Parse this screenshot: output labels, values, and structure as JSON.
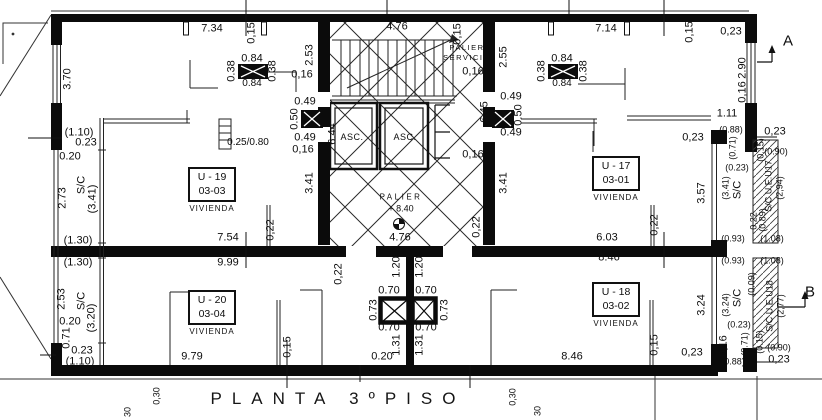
{
  "plan": {
    "title": "PLANTA 3ºPISO",
    "core": {
      "palier_servicio_1": "PALIER",
      "palier_servicio_2": "SERVICIO",
      "elevator_1": "ASC.",
      "elevator_2": "ASC.",
      "palier": "PALIER",
      "palier_level": "+ 8.40"
    },
    "section_markers": {
      "a": "A",
      "b": "B"
    },
    "units": [
      {
        "id": "U - 19",
        "number": "03-03",
        "use": "VIVIENDA"
      },
      {
        "id": "U - 17",
        "number": "03-01",
        "use": "VIVIENDA"
      },
      {
        "id": "U - 20",
        "number": "03-04",
        "use": "VIVIENDA"
      },
      {
        "id": "U - 18",
        "number": "03-02",
        "use": "VIVIENDA"
      }
    ],
    "dimensions": [
      {
        "t": "7.34",
        "x": 212,
        "y": 29
      },
      {
        "t": "0,15",
        "x": 252,
        "y": 33,
        "r": 1
      },
      {
        "t": "4.76",
        "x": 397,
        "y": 27
      },
      {
        "t": "0,15",
        "x": 458,
        "y": 34,
        "r": 1
      },
      {
        "t": "7.14",
        "x": 606,
        "y": 29
      },
      {
        "t": "0,15",
        "x": 690,
        "y": 32,
        "r": 1
      },
      {
        "t": "0,23",
        "x": 731,
        "y": 32
      },
      {
        "t": "2.90",
        "x": 743,
        "y": 68,
        "r": 1
      },
      {
        "t": "0,16",
        "x": 743,
        "y": 92,
        "r": 1
      },
      {
        "t": "1.11",
        "x": 727,
        "y": 114
      },
      {
        "t": "3.70",
        "x": 68,
        "y": 79,
        "r": 1
      },
      {
        "t": "(1.10)",
        "x": 79,
        "y": 133
      },
      {
        "t": "0.23",
        "x": 86,
        "y": 143
      },
      {
        "t": "0.20",
        "x": 70,
        "y": 157
      },
      {
        "t": "2.73",
        "x": 63,
        "y": 198,
        "r": 1
      },
      {
        "t": "S/C",
        "x": 82,
        "y": 185,
        "r": 1
      },
      {
        "t": "(3.41)",
        "x": 93,
        "y": 199,
        "r": 1
      },
      {
        "t": "(1.30)",
        "x": 78,
        "y": 241
      },
      {
        "t": "(1.30)",
        "x": 78,
        "y": 263
      },
      {
        "t": "2.53",
        "x": 62,
        "y": 299,
        "r": 1
      },
      {
        "t": "S/C",
        "x": 82,
        "y": 301,
        "r": 1
      },
      {
        "t": "(3.20)",
        "x": 92,
        "y": 318,
        "r": 1
      },
      {
        "t": "0.20",
        "x": 70,
        "y": 322
      },
      {
        "t": "0.71",
        "x": 67,
        "y": 338,
        "r": 1
      },
      {
        "t": "0.23",
        "x": 82,
        "y": 351
      },
      {
        "t": "(1.10)",
        "x": 80,
        "y": 362
      },
      {
        "t": "0.38",
        "x": 232,
        "y": 71,
        "r": 1
      },
      {
        "t": "0.84",
        "x": 252,
        "y": 59
      },
      {
        "t": "0.38",
        "x": 273,
        "y": 71,
        "r": 1
      },
      {
        "t": "0.84",
        "x": 252,
        "y": 84,
        "s": 10
      },
      {
        "t": "0.25/0.80",
        "x": 248,
        "y": 143,
        "s": 10
      },
      {
        "t": "2.53",
        "x": 310,
        "y": 55,
        "r": 1
      },
      {
        "t": "0,16",
        "x": 302,
        "y": 75
      },
      {
        "t": "0.49",
        "x": 305,
        "y": 102
      },
      {
        "t": "0.50",
        "x": 295,
        "y": 119,
        "r": 1
      },
      {
        "t": "0.49",
        "x": 305,
        "y": 138
      },
      {
        "t": "0,16",
        "x": 303,
        "y": 150
      },
      {
        "t": "6.44",
        "x": 333,
        "y": 134,
        "r": 1
      },
      {
        "t": "3.41",
        "x": 310,
        "y": 183,
        "r": 1
      },
      {
        "t": "7.54",
        "x": 228,
        "y": 238
      },
      {
        "t": "0,22",
        "x": 271,
        "y": 230,
        "r": 1
      },
      {
        "t": "9.99",
        "x": 228,
        "y": 263
      },
      {
        "t": "0,16",
        "x": 473,
        "y": 72
      },
      {
        "t": "6.45",
        "x": 485,
        "y": 112,
        "r": 1
      },
      {
        "t": "0.49",
        "x": 511,
        "y": 97
      },
      {
        "t": "0.50",
        "x": 519,
        "y": 115,
        "r": 1
      },
      {
        "t": "0.49",
        "x": 511,
        "y": 133
      },
      {
        "t": "0,16",
        "x": 473,
        "y": 155
      },
      {
        "t": "3.41",
        "x": 504,
        "y": 183,
        "r": 1
      },
      {
        "t": "4.76",
        "x": 400,
        "y": 238
      },
      {
        "t": "0,22",
        "x": 477,
        "y": 227,
        "r": 1
      },
      {
        "t": "2.55",
        "x": 504,
        "y": 57,
        "r": 1
      },
      {
        "t": "1.20",
        "x": 397,
        "y": 267,
        "r": 1
      },
      {
        "t": "1.20",
        "x": 420,
        "y": 267,
        "r": 1
      },
      {
        "t": "0.70",
        "x": 389,
        "y": 291
      },
      {
        "t": "0.70",
        "x": 426,
        "y": 291
      },
      {
        "t": "0.73",
        "x": 374,
        "y": 310,
        "r": 1
      },
      {
        "t": "0.73",
        "x": 445,
        "y": 310,
        "r": 1
      },
      {
        "t": "0.70",
        "x": 389,
        "y": 328
      },
      {
        "t": "0.70",
        "x": 426,
        "y": 328
      },
      {
        "t": "1.31",
        "x": 397,
        "y": 345,
        "r": 1
      },
      {
        "t": "1.31",
        "x": 420,
        "y": 345,
        "r": 1
      },
      {
        "t": "0.20",
        "x": 382,
        "y": 357
      },
      {
        "t": "0,22",
        "x": 339,
        "y": 274,
        "r": 1
      },
      {
        "t": "0,15",
        "x": 288,
        "y": 347,
        "r": 1
      },
      {
        "t": "9.79",
        "x": 192,
        "y": 357
      },
      {
        "t": "0.38",
        "x": 542,
        "y": 71,
        "r": 1
      },
      {
        "t": "0.84",
        "x": 562,
        "y": 59
      },
      {
        "t": "0.38",
        "x": 584,
        "y": 71,
        "r": 1
      },
      {
        "t": "0.84",
        "x": 562,
        "y": 84,
        "s": 10
      },
      {
        "t": "0,23",
        "x": 693,
        "y": 138
      },
      {
        "t": "3.57",
        "x": 702,
        "y": 193,
        "r": 1
      },
      {
        "t": "0,22",
        "x": 655,
        "y": 225,
        "r": 1
      },
      {
        "t": "6.03",
        "x": 607,
        "y": 238
      },
      {
        "t": "8.46",
        "x": 609,
        "y": 258
      },
      {
        "t": "(0.88)",
        "x": 731,
        "y": 130,
        "s": 9
      },
      {
        "t": "0,23",
        "x": 775,
        "y": 132
      },
      {
        "t": "(0.71)",
        "x": 733,
        "y": 148,
        "r": 1,
        "s": 9
      },
      {
        "t": "(0.23)",
        "x": 737,
        "y": 168,
        "s": 9
      },
      {
        "t": "(0.15)",
        "x": 761,
        "y": 150,
        "r": 1,
        "s": 9
      },
      {
        "t": "(0.90)",
        "x": 776,
        "y": 152,
        "s": 9
      },
      {
        "t": "(3.41)",
        "x": 726,
        "y": 188,
        "r": 1,
        "s": 9
      },
      {
        "t": "S/C",
        "x": 738,
        "y": 190,
        "r": 1
      },
      {
        "t": "S/C U.E.U17",
        "x": 769,
        "y": 186,
        "r": 1,
        "s": 9
      },
      {
        "t": "(2,94)",
        "x": 780,
        "y": 188,
        "r": 1,
        "s": 9
      },
      {
        "t": "0,22",
        "x": 754,
        "y": 221,
        "r": 1,
        "s": 9
      },
      {
        "t": "(0.89)",
        "x": 763,
        "y": 220,
        "r": 1,
        "s": 9
      },
      {
        "t": "(0.93)",
        "x": 733,
        "y": 239,
        "s": 9
      },
      {
        "t": "(1.08)",
        "x": 772,
        "y": 239,
        "s": 9
      },
      {
        "t": "(0.93)",
        "x": 733,
        "y": 261,
        "s": 9
      },
      {
        "t": "(1.08)",
        "x": 772,
        "y": 261,
        "s": 9
      },
      {
        "t": "(0.09)",
        "x": 752,
        "y": 284,
        "r": 1,
        "s": 9
      },
      {
        "t": "S/C U.E.U18",
        "x": 770,
        "y": 306,
        "r": 1,
        "s": 9
      },
      {
        "t": "(2,77)",
        "x": 781,
        "y": 306,
        "r": 1,
        "s": 9
      },
      {
        "t": "(3.24)",
        "x": 726,
        "y": 305,
        "r": 1,
        "s": 9
      },
      {
        "t": "S/C",
        "x": 738,
        "y": 298,
        "r": 1
      },
      {
        "t": "3.24",
        "x": 702,
        "y": 305,
        "r": 1
      },
      {
        "t": "(0.23)",
        "x": 739,
        "y": 325,
        "s": 9
      },
      {
        "t": "(0.71)",
        "x": 745,
        "y": 344,
        "r": 1,
        "s": 9
      },
      {
        "t": "(0.15)",
        "x": 760,
        "y": 342,
        "r": 1,
        "s": 9
      },
      {
        "t": "(0.90)",
        "x": 779,
        "y": 348,
        "s": 9
      },
      {
        "t": "0,16",
        "x": 724,
        "y": 346,
        "r": 1
      },
      {
        "t": "(0.88)",
        "x": 733,
        "y": 362,
        "s": 9
      },
      {
        "t": "0,23",
        "x": 779,
        "y": 360
      },
      {
        "t": "0,23",
        "x": 692,
        "y": 353
      },
      {
        "t": "0,15",
        "x": 655,
        "y": 345,
        "r": 1
      },
      {
        "t": "8.46",
        "x": 572,
        "y": 357
      },
      {
        "t": "0,30",
        "x": 157,
        "y": 396,
        "r": 1,
        "s": 9
      },
      {
        "t": "30",
        "x": 128,
        "y": 412,
        "r": 1,
        "s": 9
      },
      {
        "t": "0,30",
        "x": 513,
        "y": 397,
        "r": 1,
        "s": 9
      },
      {
        "t": "30",
        "x": 538,
        "y": 411,
        "r": 1,
        "s": 9
      }
    ]
  }
}
